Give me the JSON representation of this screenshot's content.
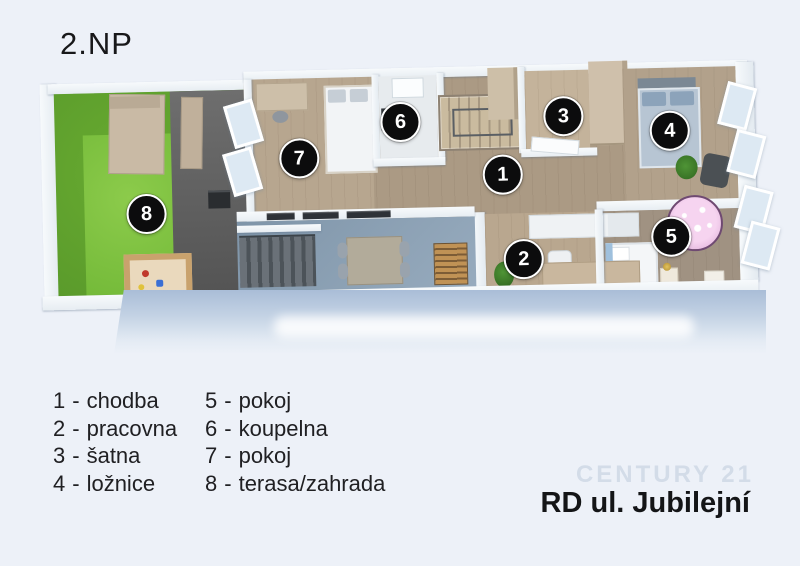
{
  "page": {
    "floor_label": "2.NP",
    "project_title": "RD ul. Jubilejní",
    "watermark": "CENTURY 21"
  },
  "legend": {
    "separator": "-",
    "items": [
      {
        "number": "1",
        "name": "chodba"
      },
      {
        "number": "2",
        "name": "pracovna"
      },
      {
        "number": "3",
        "name": "šatna"
      },
      {
        "number": "4",
        "name": "ložnice"
      },
      {
        "number": "5",
        "name": "pokoj"
      },
      {
        "number": "6",
        "name": "koupelna"
      },
      {
        "number": "7",
        "name": "pokoj"
      },
      {
        "number": "8",
        "name": "terasa/zahrada"
      }
    ]
  },
  "plan": {
    "view": "top-down 3D render of upper floor",
    "markers": [
      {
        "number": "1",
        "room": "chodba"
      },
      {
        "number": "2",
        "room": "pracovna"
      },
      {
        "number": "3",
        "room": "šatna"
      },
      {
        "number": "4",
        "room": "ložnice"
      },
      {
        "number": "5",
        "room": "pokoj"
      },
      {
        "number": "6",
        "room": "koupelna"
      },
      {
        "number": "7",
        "room": "pokoj"
      },
      {
        "number": "8",
        "room": "terasa/zahrada"
      }
    ]
  },
  "colors": {
    "background": "#edf1f8",
    "text": "#1c1c1e",
    "marker_fill": "#0c0c0d",
    "marker_text": "#ffffff",
    "grass_dark": "#5fa02c",
    "grass_light": "#80c342",
    "terrace": "#595959",
    "wood_floor": "#b2a18b",
    "walls": "#f2f5f8",
    "void_floor": "#8da2b5",
    "rug_pink": "#e3b4dc",
    "bed_blue": "#b5c3d1",
    "facade_band": "#a9bdd7"
  }
}
